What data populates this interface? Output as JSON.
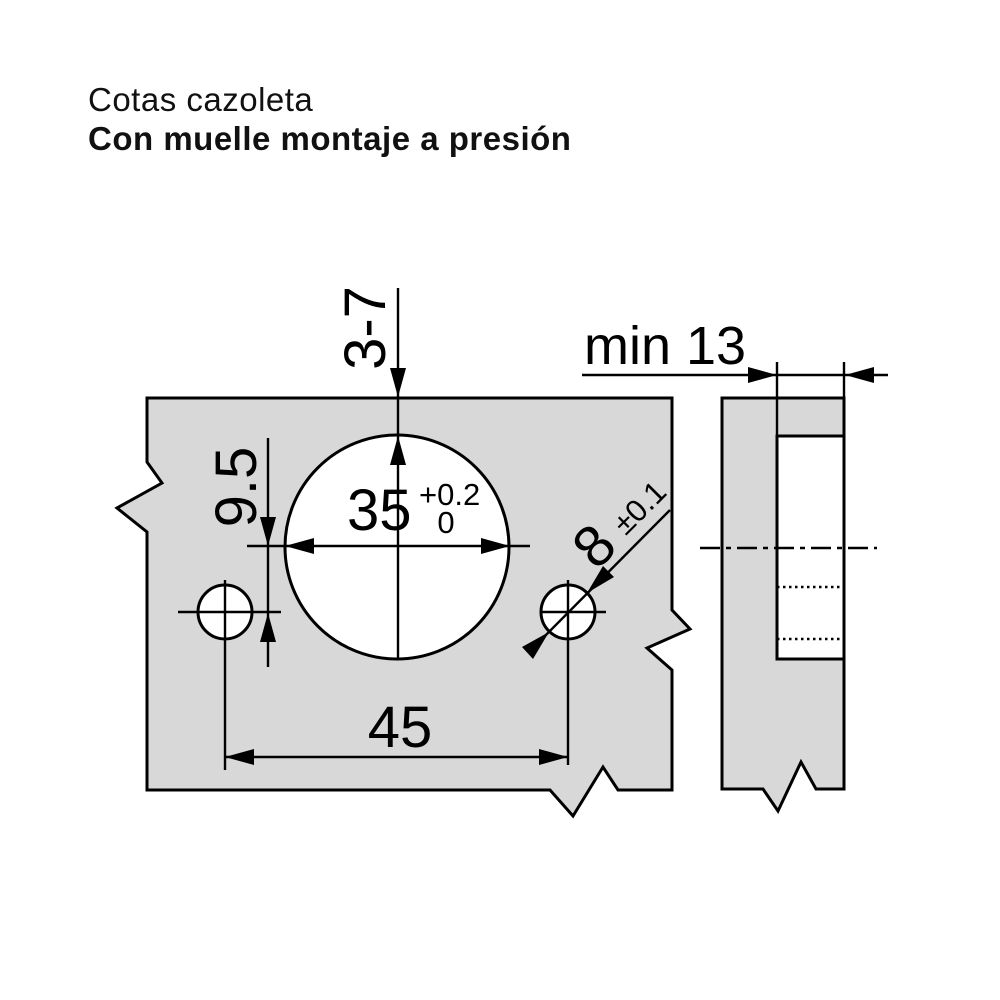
{
  "title": {
    "line1": "Cotas cazoleta",
    "line2": "Con muelle montaje a presión"
  },
  "dimensions": {
    "cup_edge_distance": "3-7",
    "dowel_vertical_offset": "9.5",
    "cup_diameter": "35",
    "cup_diameter_tol_upper": "+0.2",
    "cup_diameter_tol_lower": "0",
    "dowel_diameter": "8",
    "dowel_diameter_tol": "±0.1",
    "dowel_spacing": "45",
    "min_drilling_depth": "min 13"
  },
  "colors": {
    "background": "#ffffff",
    "panel_fill": "#d8d8d8",
    "line": "#000000",
    "text": "#111111"
  }
}
